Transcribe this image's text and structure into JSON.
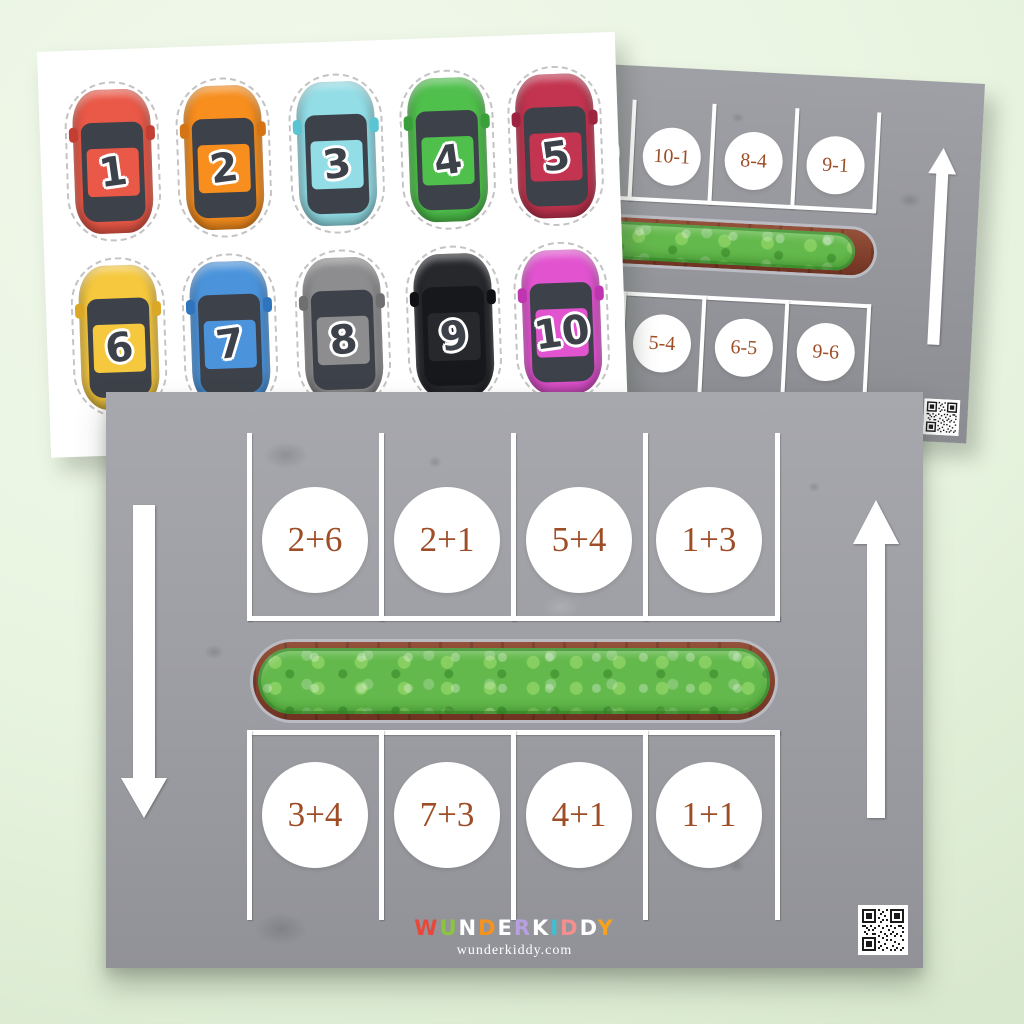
{
  "cards_sheet": {
    "cars": [
      {
        "label": "1",
        "body": "#ea5847",
        "shade": "#c43f33",
        "window": "#3d4149"
      },
      {
        "label": "2",
        "body": "#f78e1e",
        "shade": "#d47414",
        "window": "#3d4149"
      },
      {
        "label": "3",
        "body": "#92dde6",
        "shade": "#5ac4d2",
        "window": "#3d4149"
      },
      {
        "label": "4",
        "body": "#4fc04c",
        "shade": "#399f3b",
        "window": "#3d4149"
      },
      {
        "label": "5",
        "body": "#c2344f",
        "shade": "#9c2440",
        "window": "#3d4149"
      },
      {
        "label": "6",
        "body": "#f6c83e",
        "shade": "#daa726",
        "window": "#3d4149"
      },
      {
        "label": "7",
        "body": "#4b94dc",
        "shade": "#2f74bd",
        "window": "#3d4149"
      },
      {
        "label": "8",
        "body": "#8d8d8f",
        "shade": "#6f6f72",
        "window": "#3d4149"
      },
      {
        "label": "9",
        "body": "#27282c",
        "shade": "#101114",
        "window": "#17181c"
      },
      {
        "label": "10",
        "body": "#e253d0",
        "shade": "#bf35af",
        "window": "#3d4149"
      }
    ]
  },
  "addition_sheet": {
    "spots_top": [
      "2+6",
      "2+1",
      "5+4",
      "1+3"
    ],
    "spots_bottom": [
      "3+4",
      "7+3",
      "4+1",
      "1+1"
    ],
    "logo": {
      "letters": [
        {
          "ch": "W",
          "color": "#e8483b"
        },
        {
          "ch": "U",
          "color": "#8bc53f"
        },
        {
          "ch": "N",
          "color": "#ffffff"
        },
        {
          "ch": "D",
          "color": "#f6921e"
        },
        {
          "ch": "E",
          "color": "#ffffff"
        },
        {
          "ch": "R",
          "color": "#b79fe0"
        },
        {
          "ch": "K",
          "color": "#ffffff"
        },
        {
          "ch": "I",
          "color": "#35c3d6"
        },
        {
          "ch": "D",
          "color": "#f58e8e"
        },
        {
          "ch": "D",
          "color": "#ffffff"
        },
        {
          "ch": "Y",
          "color": "#f6a21e"
        }
      ],
      "website": "wunderkiddy.com"
    }
  },
  "subtraction_sheet": {
    "spots_top": [
      "",
      "10-1",
      "8-4",
      "9-1"
    ],
    "spots_bottom": [
      "",
      "5-4",
      "6-5",
      "9-6"
    ]
  },
  "colors": {
    "operation_text": "#9e4e27",
    "asphalt": "#9c9da2",
    "lane_line": "#ffffff",
    "hedge_green": "#63b94b",
    "planter_brown": "#81402c",
    "background_mint": "#e8f4e0"
  }
}
